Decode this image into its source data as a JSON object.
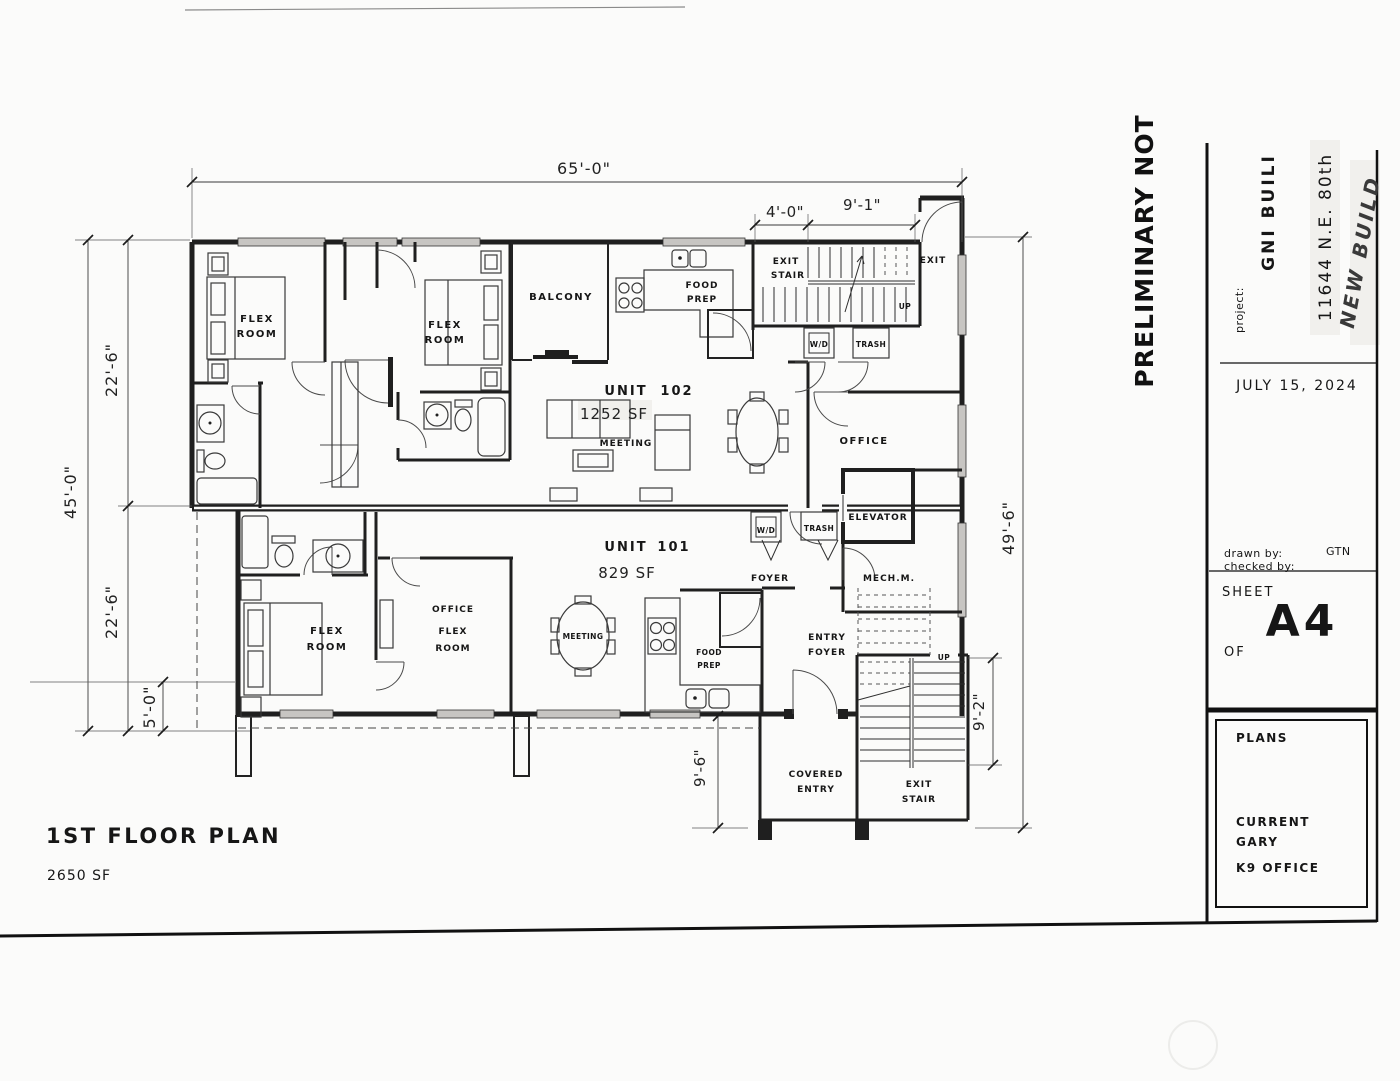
{
  "colors": {
    "ink": "#1f1f1f",
    "dimension": "#333333",
    "window_fill": "#c7c5c2",
    "paper": "#fbfbfa"
  },
  "plan": {
    "title": "1ST FLOOR PLAN",
    "total_area": "2650 SF",
    "units": {
      "u102": {
        "label": "UNIT",
        "number": "102",
        "area": "1252 SF"
      },
      "u101": {
        "label": "UNIT",
        "number": "101",
        "area": "829 SF"
      }
    },
    "rooms": {
      "flex1": [
        "FLEX",
        "ROOM"
      ],
      "flex2": [
        "FLEX",
        "ROOM"
      ],
      "flex3": [
        "FLEX",
        "ROOM"
      ],
      "office_flex": [
        "OFFICE",
        "FLEX",
        "ROOM"
      ],
      "balcony": "BALCONY",
      "food_prep_102": [
        "FOOD",
        "PREP"
      ],
      "food_prep_101": [
        "FOOD",
        "PREP"
      ],
      "meeting_102": "MEETING",
      "meeting_101": "MEETING",
      "office": "OFFICE",
      "elevator": "ELEVATOR",
      "mech": "MECH.M.",
      "foyer": "FOYER",
      "entry_foyer": [
        "ENTRY",
        "FOYER"
      ],
      "covered_entry": [
        "COVERED",
        "ENTRY"
      ],
      "exit_stair_upper": [
        "EXIT",
        "STAIR"
      ],
      "exit_stair_lower": [
        "EXIT",
        "STAIR"
      ],
      "exit": "EXIT",
      "up_upper": "UP",
      "up_lower": "UP",
      "wd_102": "W/D",
      "trash_102": "TRASH",
      "wd_101": "W/D",
      "trash_101": "TRASH"
    },
    "dimensions": {
      "width_total": "65'-0\"",
      "stair_landing": "4'-0\"",
      "stair_run": "9'-1\"",
      "depth_upper": "22'-6\"",
      "depth_total": "45'-0\"",
      "depth_lower": "22'-6\"",
      "deck": "5'-0\"",
      "right_total": "49'-6\"",
      "stair_lower": "9'-2\"",
      "entry_depth": "9'-6\""
    }
  },
  "title_block": {
    "stamp": "PRELIMINARY NOT",
    "project_label": "project:",
    "project_name": "GNI BUILI",
    "address": "11644 N.E. 80th",
    "note": "NEW BUILD",
    "date": "JULY 15, 2024",
    "drawn_by_label": "drawn by:",
    "drawn_by": "GTN",
    "checked_by_label": "checked by:",
    "sheet_label": "SHEET",
    "sheet_number": "A4",
    "of_label": "OF",
    "box_title": "PLANS",
    "box_lines": [
      "CURRENT",
      "GARY",
      "K9 OFFICE"
    ]
  }
}
